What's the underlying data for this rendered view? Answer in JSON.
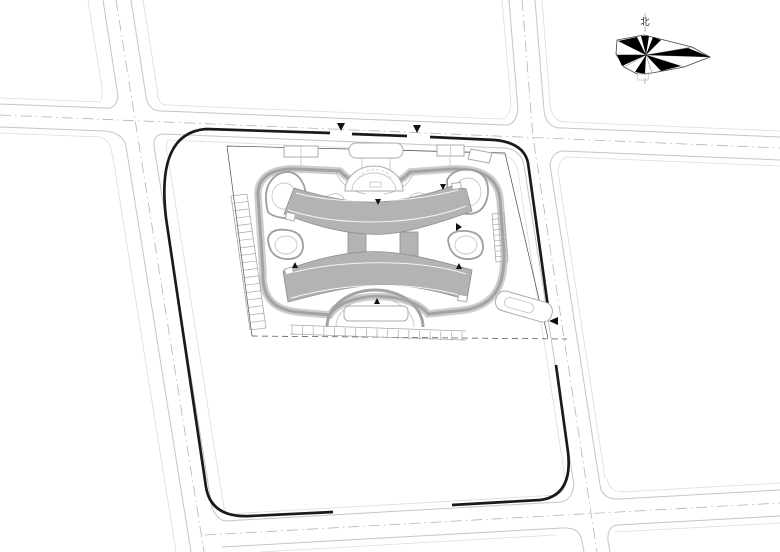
{
  "drawing": {
    "kind": "architectural-site-plan",
    "north_label": "北",
    "colors": {
      "paper": "#ffffff",
      "boundary": "#1a1a1a",
      "building": "#b3b3b3",
      "ring": "#a3a3a3",
      "road": "#c5c5c5",
      "centerline": "#b5b5b5"
    }
  }
}
